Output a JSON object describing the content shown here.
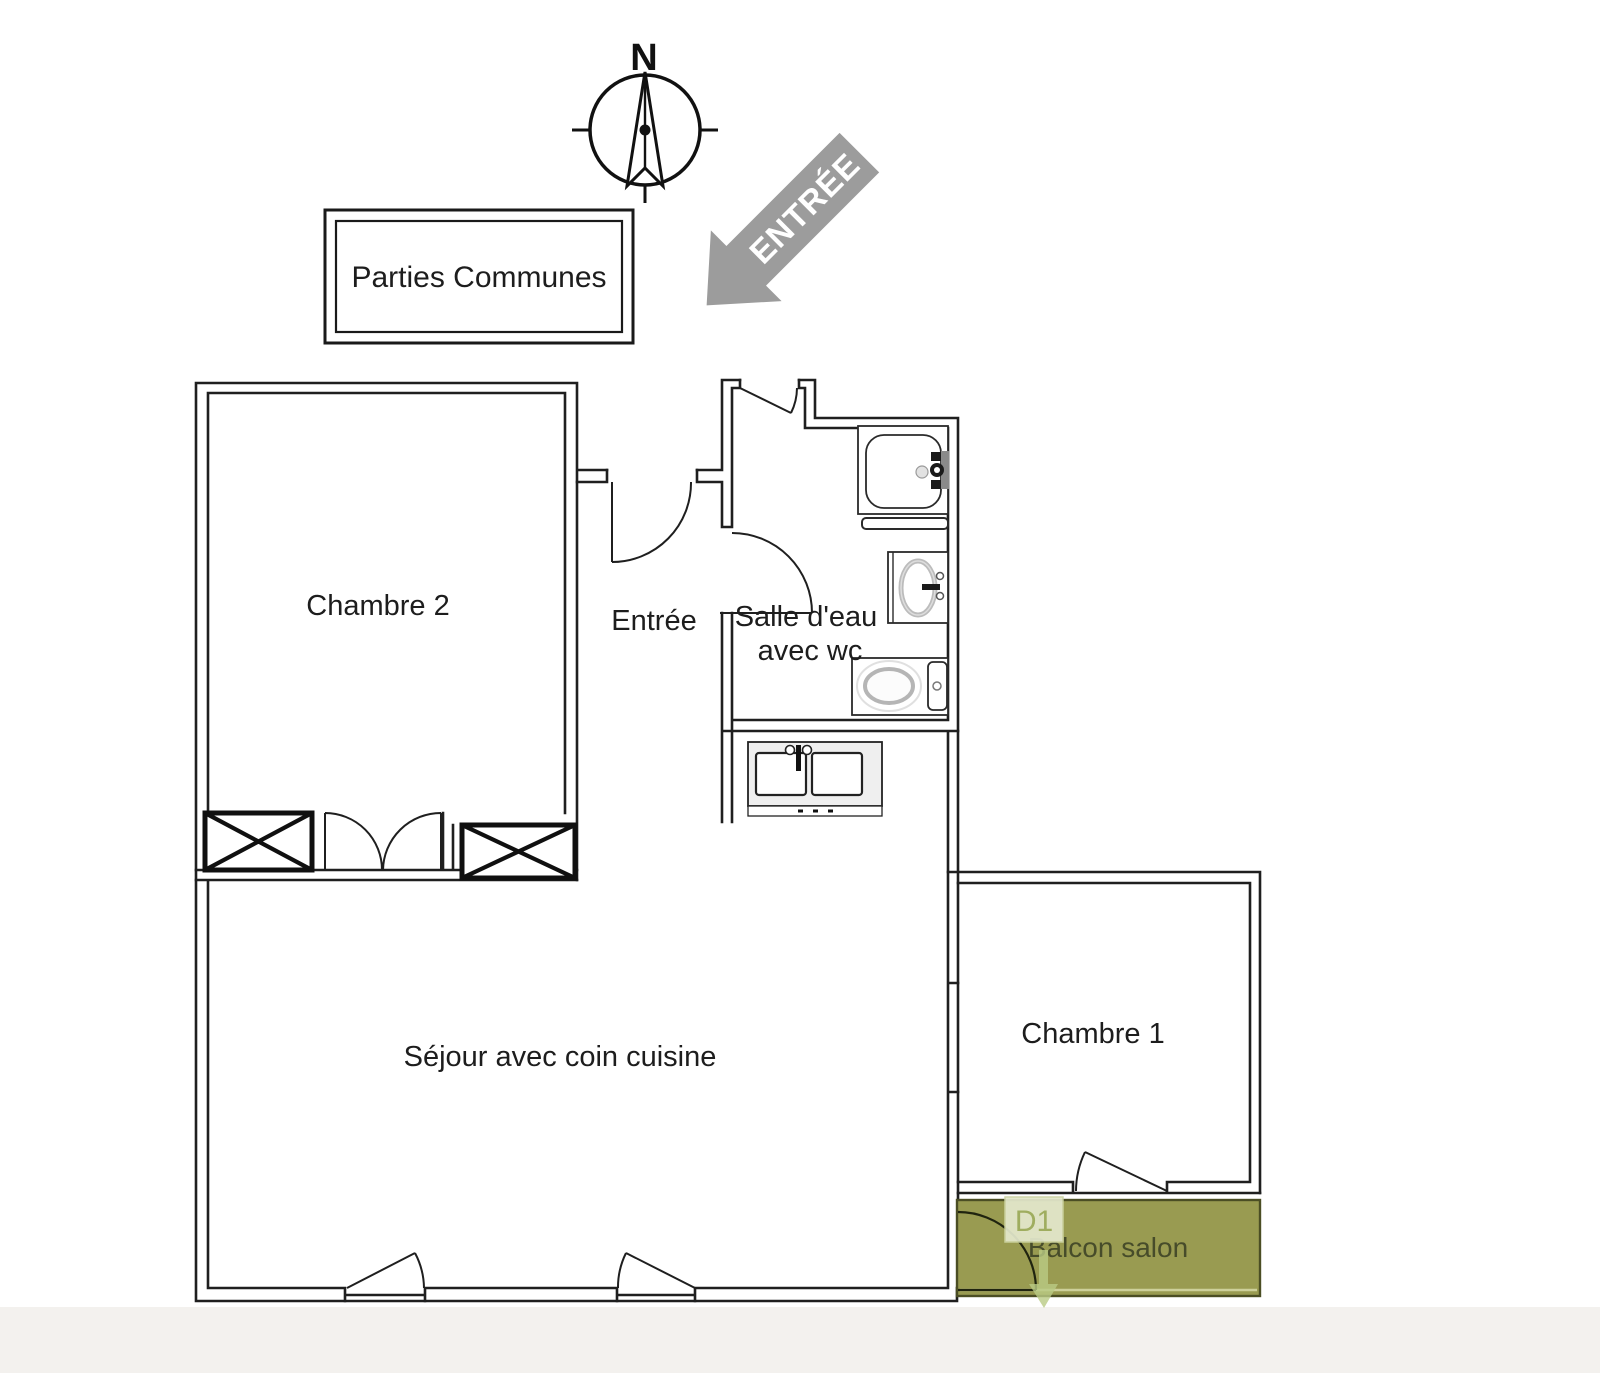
{
  "compass": {
    "north_label": "N"
  },
  "entrance_arrow": {
    "label": "ENTRÉE"
  },
  "legend": {
    "parties_communes": "Parties Communes"
  },
  "rooms": {
    "chambre_2": "Chambre 2",
    "entree": "Entrée",
    "salle_deau_line1": "Salle d'eau",
    "salle_deau_line2": "avec wc",
    "sejour": "Séjour avec coin cuisine",
    "chambre_1": "Chambre 1"
  },
  "balcony": {
    "label": "Balcon salon",
    "door_tag": "D1"
  },
  "colors": {
    "wall": "#1f1f1f",
    "balcony_fill": "#999b51",
    "balcony_stroke": "#4b4e24",
    "balcony_inner_line": "#cdd09a",
    "balcony_text": "#474c2a",
    "d1_box_fill": "#e4e9cd",
    "d1_box_stroke": "#ccd3a2",
    "d1_text": "#9fad5f",
    "arrow_fill": "#9c9c9c",
    "arrow_text": "#ffffff",
    "direction_arrow": "#b9ca84",
    "page_bottom_band": "#f3f1ee"
  }
}
